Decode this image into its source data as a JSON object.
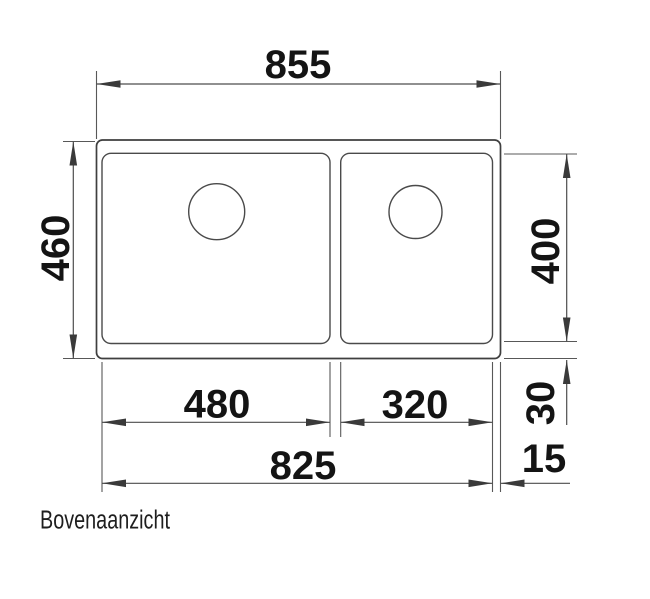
{
  "drawing": {
    "view_label": "Bovenaanzicht",
    "dimensions": {
      "overall_width": "855",
      "overall_depth": "460",
      "bowl_depth": "400",
      "left_bowl_width": "480",
      "right_bowl_width": "320",
      "bottom_rim": "30",
      "bowls_outer_span": "825",
      "right_rim": "15"
    },
    "colors": {
      "background": "#ffffff",
      "line_color": "#4a4a4a",
      "text_color": "#141414"
    }
  }
}
